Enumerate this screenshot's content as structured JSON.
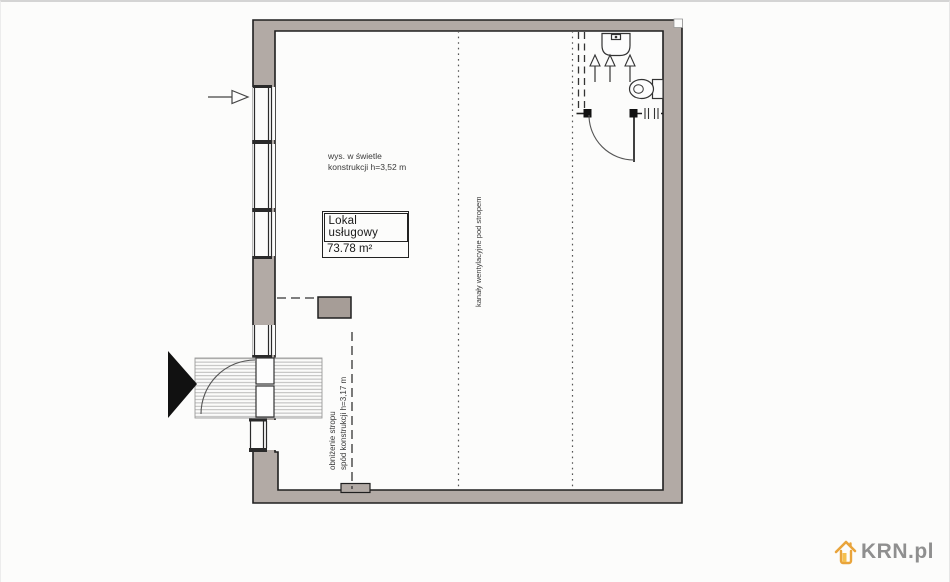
{
  "plan": {
    "room_label": {
      "name": "Lokal usługowy",
      "area": "73.78 m²"
    },
    "notes": {
      "clear_height_line1": "wys. w świetle",
      "clear_height_line2": "konstrukcji h=3,52 m",
      "vent_ducts": "kanały wentylacyjne pod stropem",
      "ceiling_drop_line1": "obniżenie stropu",
      "ceiling_drop_line2": "spód konstrukcji h=3,17 m"
    },
    "icons": {
      "toilet": "toilet-icon",
      "sink": "sink-icon",
      "vent_arrows": "up-arrow-icons",
      "entry_direction": "entry-triangle-icon",
      "west_wall_pointer": "right-arrow-icon",
      "watermark_house": "house-icon"
    },
    "colors": {
      "wall_fill": "#b2aaa5",
      "column_fill": "#a69d97",
      "line": "#1f1f1f"
    }
  },
  "watermark": {
    "brand": "KRN.pl",
    "accent": "#e9a43b",
    "accent_light": "#f5c04e",
    "text_color": "#8f8f8f"
  }
}
